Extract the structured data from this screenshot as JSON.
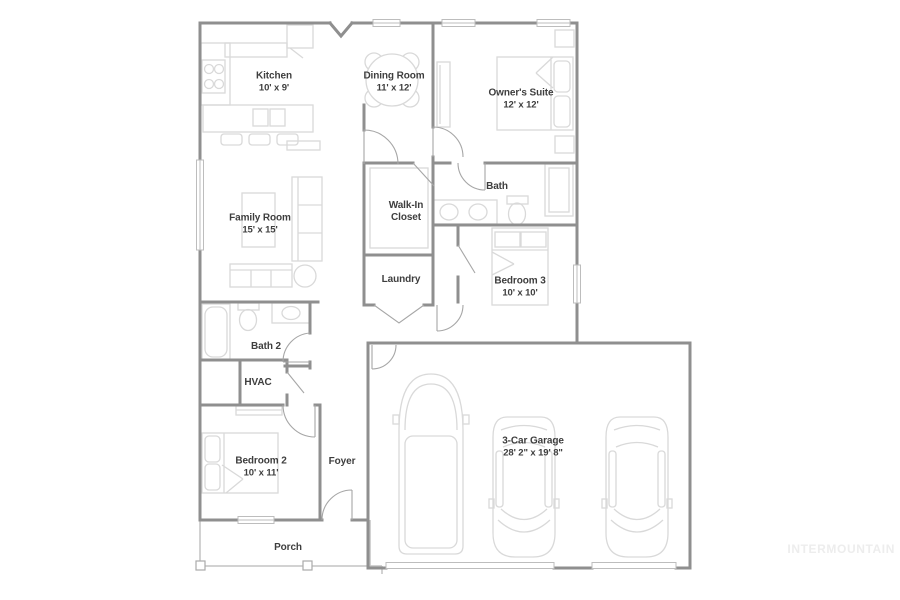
{
  "watermark": "INTERMOUNTAIN",
  "rooms": {
    "kitchen": {
      "name": "Kitchen",
      "dims": "10' x 9'"
    },
    "dining": {
      "name": "Dining Room",
      "dims": "11' x 12'"
    },
    "owners_suite": {
      "name": "Owner's Suite",
      "dims": "12' x 12'"
    },
    "family": {
      "name": "Family Room",
      "dims": "15' x 15'"
    },
    "walk_in_closet": {
      "name": "Walk-In\nCloset"
    },
    "bath": {
      "name": "Bath"
    },
    "laundry": {
      "name": "Laundry"
    },
    "bedroom3": {
      "name": "Bedroom 3",
      "dims": "10' x 10'"
    },
    "bath2": {
      "name": "Bath 2"
    },
    "hvac": {
      "name": "HVAC"
    },
    "bedroom2": {
      "name": "Bedroom 2",
      "dims": "10' x 11'"
    },
    "foyer": {
      "name": "Foyer"
    },
    "porch": {
      "name": "Porch"
    },
    "garage": {
      "name": "3-Car Garage",
      "dims": "28' 2\" x 19' 8\""
    }
  },
  "colors": {
    "wall": "#8f8f8f",
    "furniture": "#d9d9d9",
    "door": "#a6a6a6",
    "window": "#bdbdbd",
    "text": "#3e3e3e",
    "watermark": "#ededed",
    "background": "#ffffff"
  }
}
